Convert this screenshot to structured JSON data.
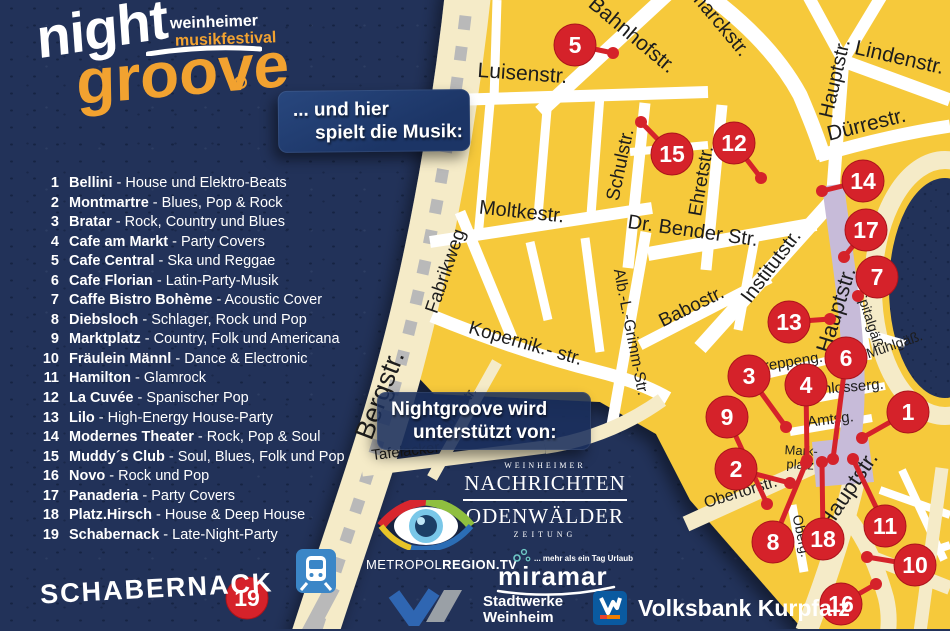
{
  "colors": {
    "background": "#223259",
    "map_yellow": "#f6c93b",
    "road_cream": "#f5ebc8",
    "road_white": "#ffffff",
    "pedestrian_purple": "#c7bbd9",
    "pin_red": "#d5222a",
    "logo_orange": "#f2a230",
    "rail_gray": "#b9b9b9",
    "station_blue": "#3b86c7",
    "volksbank_blue": "#0a5aa0",
    "volksbank_orange": "#f07d00"
  },
  "logo": {
    "night": "night",
    "groove": "groove",
    "tagline1": "weinheimer",
    "tagline2": "musikfestival"
  },
  "intro_box": {
    "line1": "... und hier",
    "line2": "spielt die Musik:"
  },
  "ui": {
    "list_separator": " - "
  },
  "venues": [
    {
      "num": "1",
      "name": "Bellini",
      "genre": "House und Elektro-Beats"
    },
    {
      "num": "2",
      "name": "Montmartre",
      "genre": "Blues, Pop & Rock"
    },
    {
      "num": "3",
      "name": "Bratar",
      "genre": "Rock, Country und Blues"
    },
    {
      "num": "4",
      "name": "Cafe am Markt",
      "genre": "Party Covers"
    },
    {
      "num": "5",
      "name": "Cafe Central",
      "genre": "Ska und Reggae"
    },
    {
      "num": "6",
      "name": "Cafe Florian",
      "genre": "Latin-Party-Musik"
    },
    {
      "num": "7",
      "name": "Caffe Bistro Bohème",
      "genre": "Acoustic Cover"
    },
    {
      "num": "8",
      "name": "Diebsloch",
      "genre": "Schlager, Rock und Pop"
    },
    {
      "num": "9",
      "name": "Marktplatz",
      "genre": "Country, Folk und Americana"
    },
    {
      "num": "10",
      "name": "Fräulein Männl",
      "genre": "Dance & Electronic"
    },
    {
      "num": "11",
      "name": "Hamilton",
      "genre": "Glamrock"
    },
    {
      "num": "12",
      "name": "La Cuvée",
      "genre": "Spanischer Pop"
    },
    {
      "num": "13",
      "name": "Lilo",
      "genre": "High-Energy House-Party"
    },
    {
      "num": "14",
      "name": "Modernes Theater",
      "genre": "Rock, Pop & Soul"
    },
    {
      "num": "15",
      "name": "Muddy´s Club",
      "genre": "Soul, Blues, Folk und Pop"
    },
    {
      "num": "16",
      "name": "Novo",
      "genre": "Rock und Pop"
    },
    {
      "num": "17",
      "name": "Panaderia",
      "genre": "Party Covers"
    },
    {
      "num": "18",
      "name": "Platz.Hirsch",
      "genre": "House & Deep House"
    },
    {
      "num": "19",
      "name": "Schabernack",
      "genre": "Late-Night-Party"
    }
  ],
  "support_box": {
    "line1": "Nightgroove wird",
    "line2": "unterstützt von:"
  },
  "sponsors": {
    "wn": {
      "top": "WEINHEIMER",
      "main": "NACHRICHTEN",
      "second": "ODENWÄLDER",
      "bottom": "ZEITUNG"
    },
    "metropol": {
      "label_thin": "METROPOL",
      "label_bold": "REGION.TV"
    },
    "miramar": {
      "name": "miramar",
      "tagline": "... mehr als ein Tag Urlaub"
    },
    "stadtwerke": {
      "line1": "Stadtwerke",
      "line2": "Weinheim"
    },
    "volksbank": {
      "label": "Volksbank Kurpfalz"
    }
  },
  "schabernack": {
    "label": "SCHABERNACK"
  },
  "map": {
    "streets": [
      {
        "label": "Bahnhofstr.",
        "x": 628,
        "y": 40,
        "rot": 40,
        "size": 21
      },
      {
        "label": "Bismarckstr.",
        "x": 706,
        "y": 16,
        "rot": 50,
        "size": 20
      },
      {
        "label": "Luisenstr.",
        "x": 522,
        "y": 80,
        "rot": 4,
        "size": 21
      },
      {
        "label": "Lindenstr.",
        "x": 898,
        "y": 64,
        "rot": 13,
        "size": 21
      },
      {
        "label": "Hauptstr.",
        "x": 841,
        "y": 80,
        "rot": -77,
        "size": 20
      },
      {
        "label": "Dürrestr.",
        "x": 868,
        "y": 131,
        "rot": -14,
        "size": 21
      },
      {
        "label": "Schulstr.",
        "x": 626,
        "y": 166,
        "rot": -78,
        "size": 19
      },
      {
        "label": "Ehretstr.",
        "x": 707,
        "y": 182,
        "rot": -80,
        "size": 19
      },
      {
        "label": "Moltkestr.",
        "x": 521,
        "y": 218,
        "rot": 6,
        "size": 20
      },
      {
        "label": "Dr. Bender Str.",
        "x": 692,
        "y": 237,
        "rot": 8,
        "size": 20
      },
      {
        "label": "Institutstr.",
        "x": 776,
        "y": 270,
        "rot": -53,
        "size": 20
      },
      {
        "label": "Fabrikweg",
        "x": 451,
        "y": 273,
        "rot": -71,
        "size": 19
      },
      {
        "label": "Kopernik.- str.",
        "x": 524,
        "y": 349,
        "rot": 16,
        "size": 19
      },
      {
        "label": "Alb.-L.-Grimm-Str.",
        "x": 626,
        "y": 333,
        "rot": 79,
        "size": 16
      },
      {
        "label": "Babostr.",
        "x": 694,
        "y": 312,
        "rot": -26,
        "size": 19
      },
      {
        "label": "Bergstr.",
        "x": 388,
        "y": 398,
        "rot": -69,
        "size": 27
      },
      {
        "label": "Leibn. Str.",
        "x": 459,
        "y": 417,
        "rot": -55,
        "size": 14
      },
      {
        "label": "Tafelacker",
        "x": 406,
        "y": 456,
        "rot": -7,
        "size": 15
      },
      {
        "label": "Hauptstr.",
        "x": 843,
        "y": 312,
        "rot": -73,
        "size": 22
      },
      {
        "label": "Spitalgäß.",
        "x": 866,
        "y": 322,
        "rot": 72,
        "size": 14
      },
      {
        "label": "Mühlgäß.",
        "x": 896,
        "y": 349,
        "rot": -19,
        "size": 14
      },
      {
        "label": "Kreppeng.",
        "x": 789,
        "y": 367,
        "rot": -9,
        "size": 15
      },
      {
        "label": "Schlosserg.",
        "x": 845,
        "y": 392,
        "rot": -5,
        "size": 15
      },
      {
        "label": "Amtsg.",
        "x": 831,
        "y": 424,
        "rot": -7,
        "size": 15
      },
      {
        "label": "Mark-",
        "x": 801,
        "y": 455,
        "rot": 3,
        "size": 13
      },
      {
        "label": "platz",
        "x": 800,
        "y": 469,
        "rot": 3,
        "size": 13
      },
      {
        "label": "Obertorstr.",
        "x": 742,
        "y": 497,
        "rot": -17,
        "size": 16
      },
      {
        "label": "Oberg.",
        "x": 797,
        "y": 537,
        "rot": 78,
        "size": 14
      },
      {
        "label": "Hauptstr.",
        "x": 854,
        "y": 494,
        "rot": -56,
        "size": 22
      }
    ],
    "pins": [
      {
        "n": "5",
        "x": 575,
        "y": 45,
        "dx": 613,
        "dy": 53
      },
      {
        "n": "15",
        "x": 672,
        "y": 154,
        "dx": 641,
        "dy": 122
      },
      {
        "n": "12",
        "x": 734,
        "y": 143,
        "dx": 761,
        "dy": 178
      },
      {
        "n": "14",
        "x": 863,
        "y": 181,
        "dx": 822,
        "dy": 191
      },
      {
        "n": "17",
        "x": 866,
        "y": 230,
        "dx": 844,
        "dy": 257
      },
      {
        "n": "7",
        "x": 877,
        "y": 277,
        "dx": 858,
        "dy": 296
      },
      {
        "n": "13",
        "x": 789,
        "y": 322,
        "dx": 830,
        "dy": 319
      },
      {
        "n": "6",
        "x": 846,
        "y": 358,
        "dx": 833,
        "dy": 459
      },
      {
        "n": "3",
        "x": 749,
        "y": 376,
        "dx": 786,
        "dy": 427
      },
      {
        "n": "4",
        "x": 806,
        "y": 385,
        "dx": 807,
        "dy": 460
      },
      {
        "n": "9",
        "x": 727,
        "y": 417,
        "dx": 767,
        "dy": 504
      },
      {
        "n": "1",
        "x": 908,
        "y": 412,
        "dx": 862,
        "dy": 438
      },
      {
        "n": "2",
        "x": 736,
        "y": 469,
        "dx": 790,
        "dy": 483
      },
      {
        "n": "8",
        "x": 773,
        "y": 542,
        "dx": 806,
        "dy": 463
      },
      {
        "n": "18",
        "x": 823,
        "y": 539,
        "dx": 822,
        "dy": 462
      },
      {
        "n": "11",
        "x": 885,
        "y": 526,
        "dx": 853,
        "dy": 459
      },
      {
        "n": "10",
        "x": 915,
        "y": 565,
        "dx": 867,
        "dy": 557
      },
      {
        "n": "16",
        "x": 841,
        "y": 604,
        "dx": 876,
        "dy": 584
      },
      {
        "n": "19",
        "x": 247,
        "y": 598
      }
    ]
  }
}
